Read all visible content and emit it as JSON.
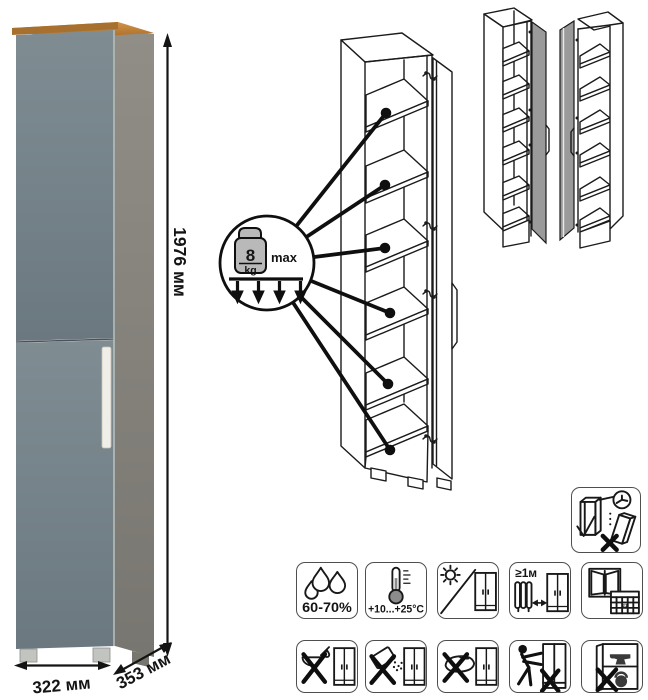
{
  "dimensions": {
    "height": "1976 мм",
    "width": "322 мм",
    "depth": "353 мм"
  },
  "shelf_callout": {
    "weight": "8",
    "unit": "kg",
    "qualifier": "max",
    "marked_shelves": 6
  },
  "views": {
    "photo": "assembled-cabinet-front-view",
    "diagram": "open-cabinet-with-shelf-load-callout",
    "variants": [
      "door-hinged-right",
      "door-hinged-left"
    ]
  },
  "care_icons": {
    "humidity": {
      "name": "humidity-icon",
      "label": "60-70%"
    },
    "temperature": {
      "name": "temperature-icon",
      "label": "+10...+25°C"
    },
    "sunlight": {
      "name": "no-direct-sunlight-icon"
    },
    "heat_distance": {
      "name": "keep-1m-from-heat-icon",
      "label": "≥1м"
    },
    "ventilation": {
      "name": "ventilation-calendar-icon",
      "calendar_day": "21"
    },
    "no_liquids": {
      "name": "no-aggressive-liquids-icon"
    },
    "no_powder": {
      "name": "no-abrasive-powder-icon"
    },
    "no_sponge": {
      "name": "no-abrasive-sponge-icon"
    },
    "no_drag": {
      "name": "do-not-drag-icon"
    },
    "no_overload": {
      "name": "do-not-overload-icon"
    },
    "wall_anchor": {
      "name": "anchor-to-wall-icon"
    }
  },
  "colors": {
    "door_front": "#75828a",
    "side_panel": "#85837b",
    "top_board_wood": "#b5742e",
    "handle": "#f0eee8",
    "variant_door_gray": "#9a9a9a",
    "line_art": "#1b1b1b"
  }
}
